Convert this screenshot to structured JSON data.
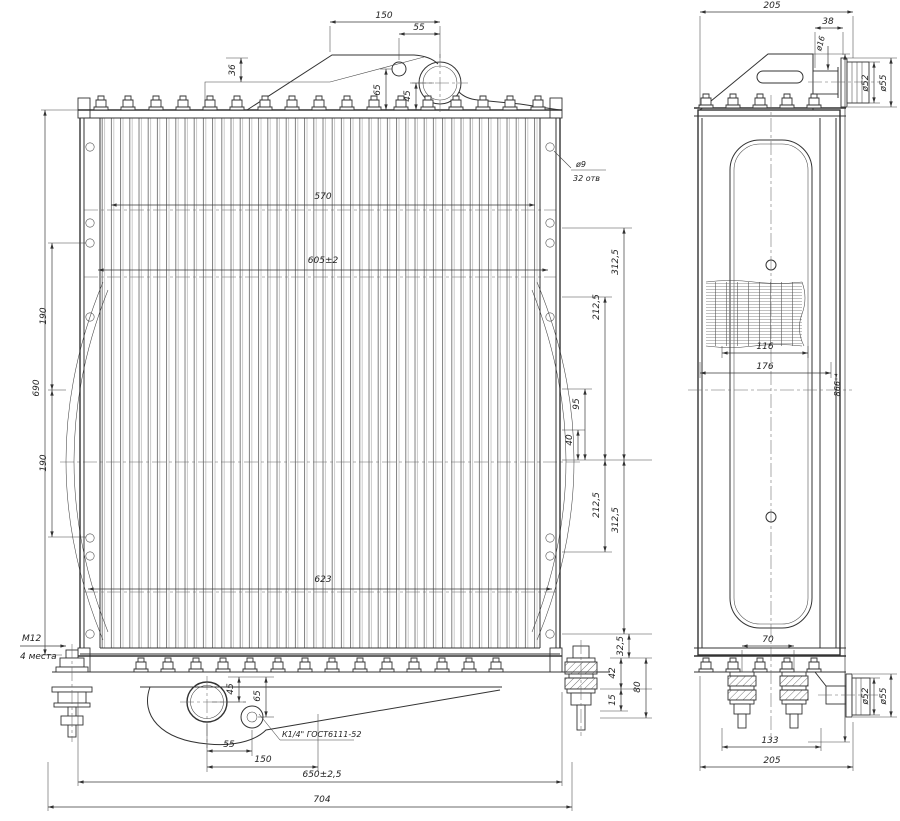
{
  "colors": {
    "ink": "#333333",
    "background": "#ffffff"
  },
  "fv": {
    "d150": "150",
    "d55": "55",
    "d36": "36",
    "d65": "65",
    "d45": "45",
    "hole_dia": "ø9",
    "hole_qty": "32 отв",
    "d570": "570",
    "d605": "605±2",
    "d623": "623",
    "d690": "690",
    "d190a": "190",
    "d190b": "190",
    "d3125a": "312,5",
    "d2125a": "212,5",
    "d95": "95",
    "d40": "40",
    "d2125b": "212,5",
    "d3125b": "312,5",
    "d325": "32,5",
    "d42": "42",
    "d15": "15",
    "d80": "80",
    "m12": "М12",
    "m12n": "4 места",
    "d45b": "45",
    "d65b": "65",
    "drain": "К1/4\" ГОСТ6111-52",
    "d55b": "55",
    "d150b": "150",
    "d650": "650±2,5",
    "d704": "704"
  },
  "sv": {
    "d205": "205",
    "d38": "38",
    "dia16": "ø16",
    "dia52": "ø52",
    "dia55": "ø55",
    "d116": "116",
    "d176": "176",
    "d866": "866⁺⁴",
    "d70": "70",
    "d133": "133",
    "d205b": "205",
    "dia52b": "ø52",
    "dia55b": "ø55"
  }
}
